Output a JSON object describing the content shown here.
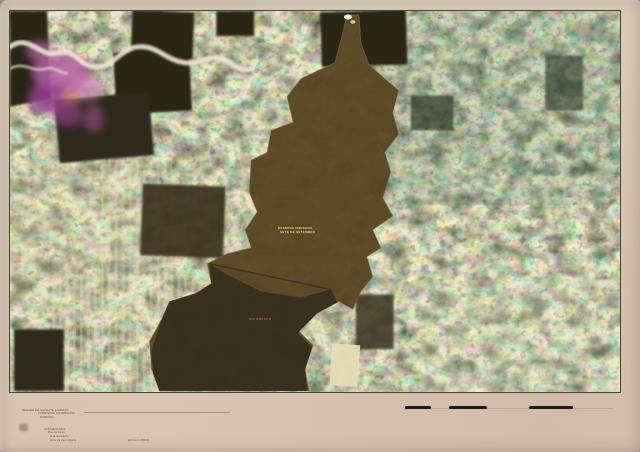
{
  "colors": {
    "paper": "#d9c8b6",
    "field_cream": "#d8d2a2",
    "field_green": "#6f9372",
    "field_teal": "#3f7262",
    "forest_dark": "#2c2618",
    "reserve_brown": "#5e4b2a",
    "reserve_dark_lobe": "#372f1f",
    "burn_magenta": "#b35fa3",
    "river_white": "#ece4d0",
    "label_yellow": "#e0cb6a",
    "label_red": "#c05565",
    "scalebar_black": "#1f1913"
  },
  "photo": {
    "reserve_label_line1": "RESERVA INDIGENA",
    "reserve_label_line2": "SETE DE SETEMBRO",
    "river_label": "RIO BRANCO"
  },
  "legend": {
    "title": "IMAGEM DE SATELITE LANDSAT",
    "line2": "COMPOSICAO COLORIDA MSS",
    "line3": "RONDONIA",
    "heading": "CONVENCOES",
    "items": [
      "Floresta densa",
      "Area desmatada",
      "Limite da area indigena",
      "Estrada principal"
    ],
    "scale_note": "ESCALA 1:250000"
  }
}
